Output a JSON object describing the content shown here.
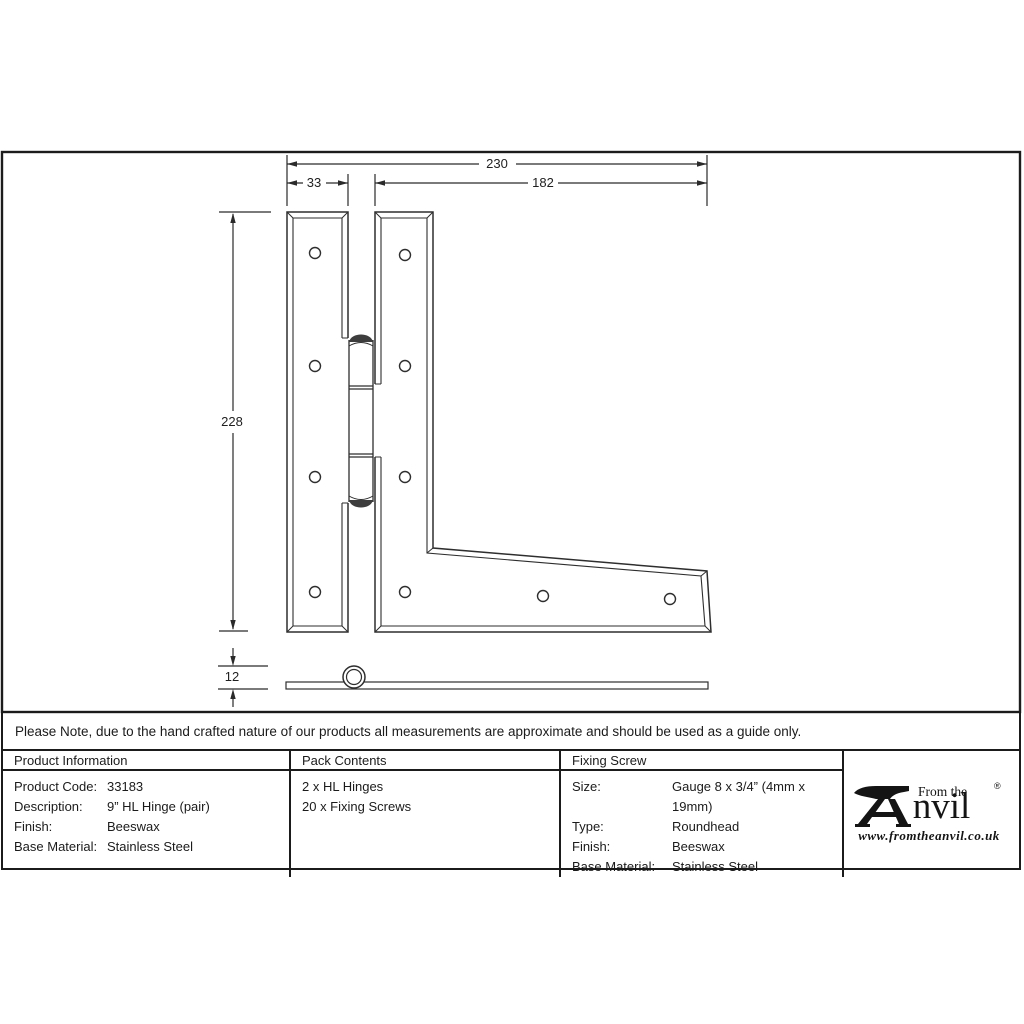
{
  "drawing": {
    "dim_total_width": "230",
    "dim_left_leaf_width": "33",
    "dim_right_leaf_width": "182",
    "dim_height": "228",
    "dim_thickness": "12"
  },
  "note": {
    "text": "Please Note, due to the hand crafted nature of our products all measurements are approximate and should be used as a guide only."
  },
  "table": {
    "product_info": {
      "header": "Product Information",
      "rows": [
        {
          "label": "Product Code:",
          "value": "33183"
        },
        {
          "label": "Description:",
          "value": "9” HL Hinge (pair)"
        },
        {
          "label": "Finish:",
          "value": "Beeswax"
        },
        {
          "label": "Base Material:",
          "value": "Stainless Steel"
        }
      ]
    },
    "pack_contents": {
      "header": "Pack Contents",
      "items": [
        "2 x HL Hinges",
        "20 x Fixing Screws"
      ]
    },
    "fixing_screw": {
      "header": "Fixing Screw",
      "rows": [
        {
          "label": "Size:",
          "value": "Gauge 8 x 3/4” (4mm x 19mm)"
        },
        {
          "label": "Type:",
          "value": "Roundhead"
        },
        {
          "label": "Finish:",
          "value": "Beeswax"
        },
        {
          "label": "Base Material:",
          "value": "Stainless Steel"
        }
      ]
    }
  },
  "logo": {
    "tagline": "From the",
    "brand": "Anvil",
    "registered": "®",
    "website": "www.fromtheanvil.co.uk"
  }
}
